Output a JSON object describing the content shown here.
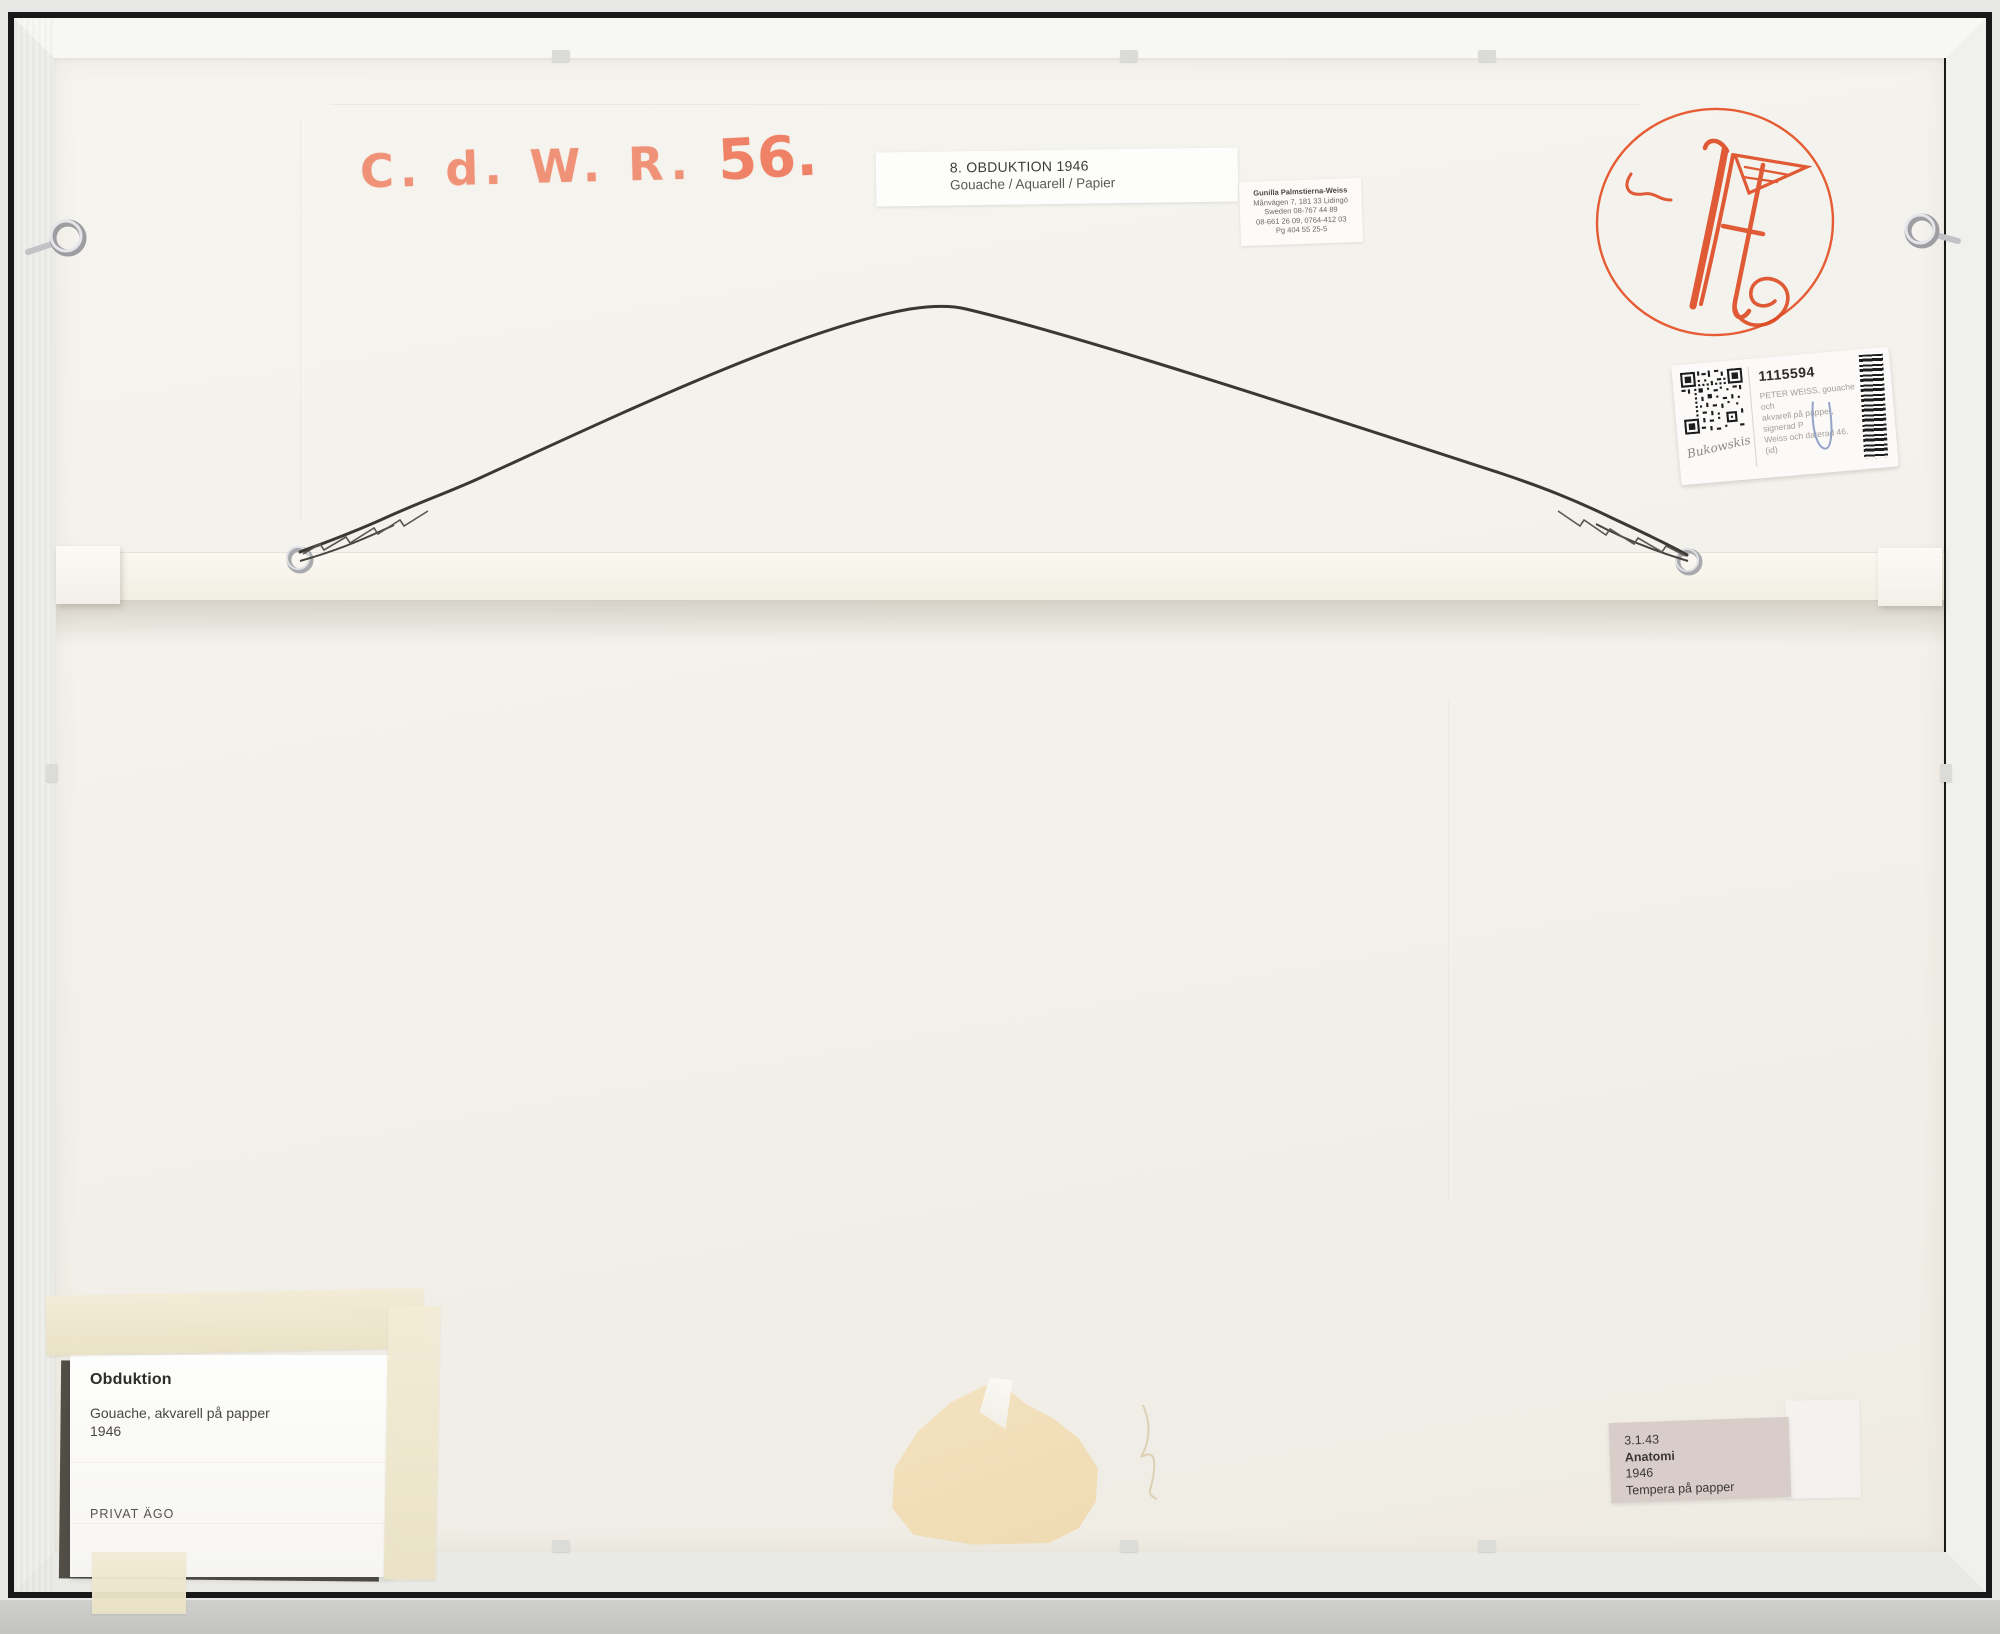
{
  "handwriting": {
    "initials": "C. d. W. R.",
    "number": "56."
  },
  "labels": {
    "top": {
      "line1": "8. OBDUKTION 1946",
      "line2": "Gouache / Aquarell / Papier"
    },
    "address": {
      "line1": "Gunilla Palmstierna-Weiss",
      "line2": "Månvägen 7, 181 33  Lidingö",
      "line3": "Sweden  08-767 44 89",
      "line4": "08-661 26 09, 0764-412 03",
      "line5": "Pg 404 55 25-5"
    },
    "auction": {
      "lot_number": "1115594",
      "desc1": "PETER WEISS, gouache och",
      "desc2": "akvarell på papper, signerad P",
      "desc3": "Weiss och daterad 46. (id)",
      "brand": "Bukowskis"
    },
    "bottom_left": {
      "title": "Obduktion",
      "medium": "Gouache, akvarell på papper",
      "year": "1946",
      "owner": "PRIVAT ÄGO"
    },
    "bottom_right": {
      "inventory": "3.1.43",
      "title": "Anatomi",
      "year": "1946",
      "medium": "Tempera på papper"
    }
  },
  "colors": {
    "marker_orange": "#f09277",
    "signature_red": "#dd4a22",
    "tape_cream": "#efe9d2",
    "label_pink": "#d9cdc9",
    "backboard": "#f3f1ec"
  }
}
